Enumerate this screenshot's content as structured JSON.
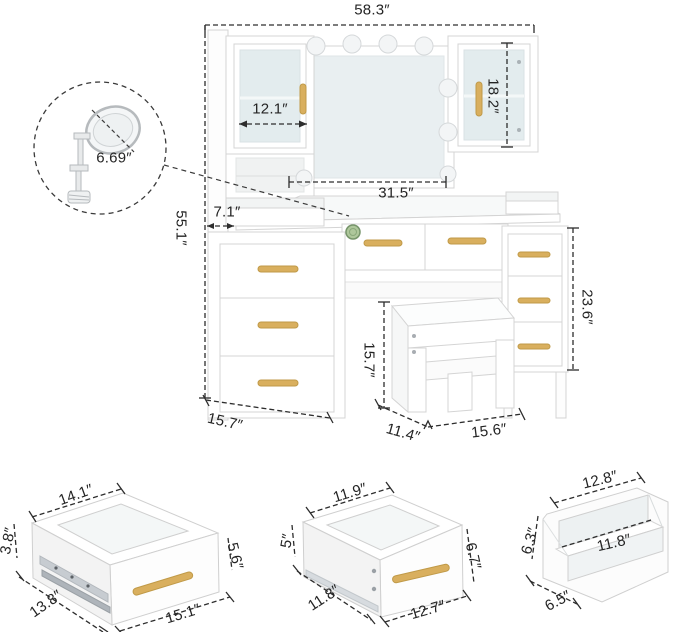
{
  "diagram_title": "vanity-desk-dimension-diagram",
  "colors": {
    "accent_gold": "#d9af5e",
    "dimension_line": "#2d2d2d",
    "frosted_glass": "#e3ecee",
    "mirror_surface": "#e9eff1",
    "green_knob": "#aec79b",
    "furniture_edge": "#d4d4d4"
  },
  "dims": {
    "overall_width": "58.3″",
    "overall_height": "55.1″",
    "left_cabinet_width": "12.1″",
    "right_cabinet_height": "18.2″",
    "mirror_width": "31.5″",
    "side_shelf_depth": "7.1″",
    "right_drawers_height": "23.6″",
    "desk_depth": "15.7″",
    "magnifier_diameter": "6.69″",
    "stool_height": "15.7″",
    "stool_depth": "11.4″",
    "stool_width": "15.6″"
  },
  "drawer_large": {
    "top_width": "14.1″",
    "back_height": "3.8″",
    "side_depth": "13.8″",
    "front_width": "15.1″",
    "front_height": "5.6″"
  },
  "drawer_small": {
    "top_width": "11.9″",
    "back_height": "5″",
    "side_depth": "11.8″",
    "front_width": "12.7″",
    "front_height": "6.7″"
  },
  "organizer": {
    "top_width": "12.8″",
    "back_height": "6.3″",
    "shelf_width": "11.8″",
    "side_depth": "6.5″"
  }
}
